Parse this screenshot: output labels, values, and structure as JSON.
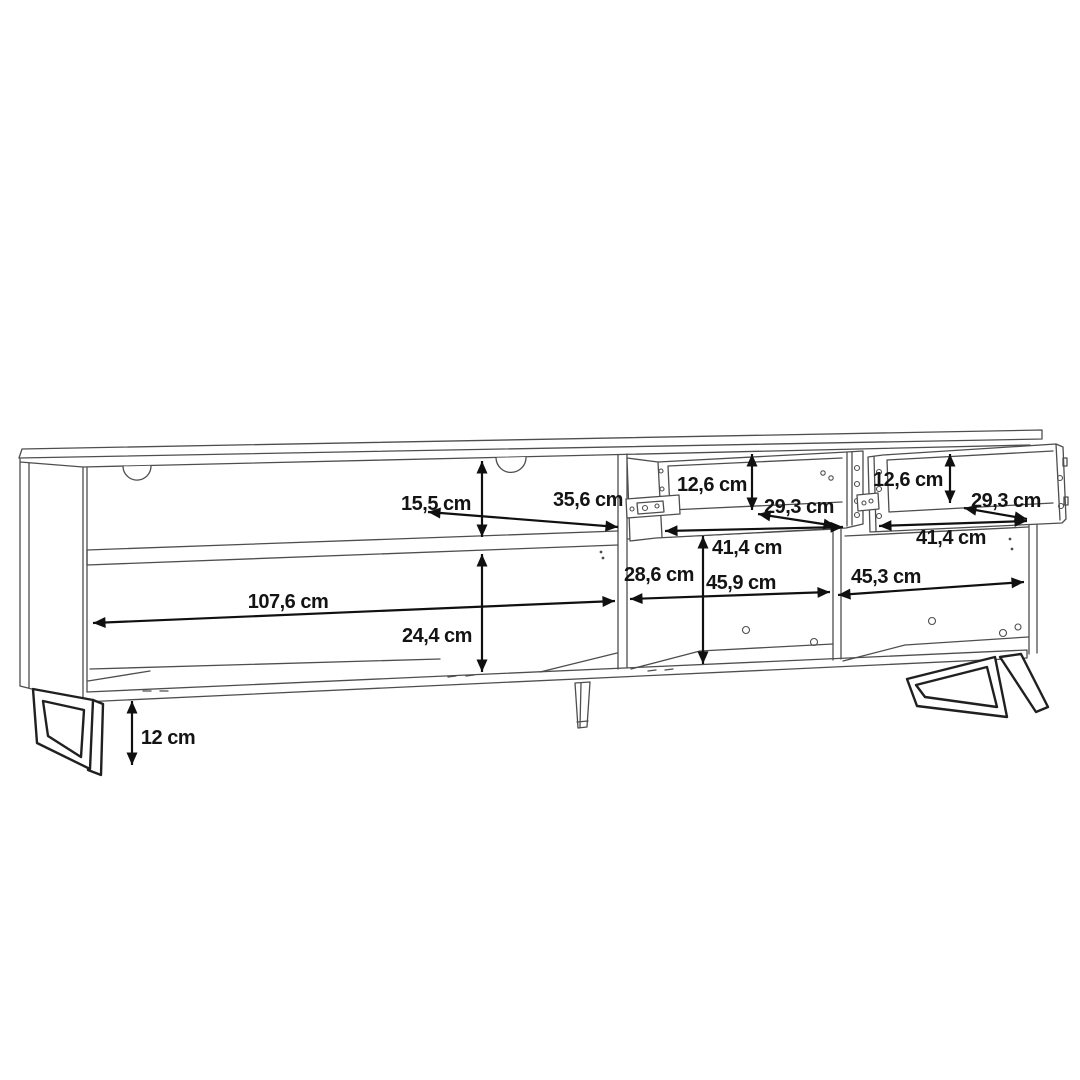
{
  "diagram": {
    "type": "furniture-dimension-drawing",
    "subject": "TV lowboard line drawing with open shelves, two pulled-out drawers, metal sled legs and dimension arrows",
    "unit": "cm",
    "colors": {
      "background": "#ffffff",
      "outline": "#4e4e4e",
      "dimension_arrow": "#101010",
      "label_text": "#141414"
    },
    "dimensions": {
      "upper_shelf_height": "15,5 cm",
      "shelf_depth": "35,6 cm",
      "left_compartment_width": "107,6 cm",
      "lower_left_height": "24,4 cm",
      "left_drawer_height": "12,6 cm",
      "left_drawer_depth": "29,3 cm",
      "left_drawer_width": "41,4 cm",
      "right_drawer_height": "12,6 cm",
      "right_drawer_depth": "29,3 cm",
      "right_drawer_width": "41,4 cm",
      "open_compartment_height": "28,6 cm",
      "middle_compartment_width": "45,9 cm",
      "right_compartment_width": "45,3 cm",
      "leg_height": "12 cm"
    }
  }
}
